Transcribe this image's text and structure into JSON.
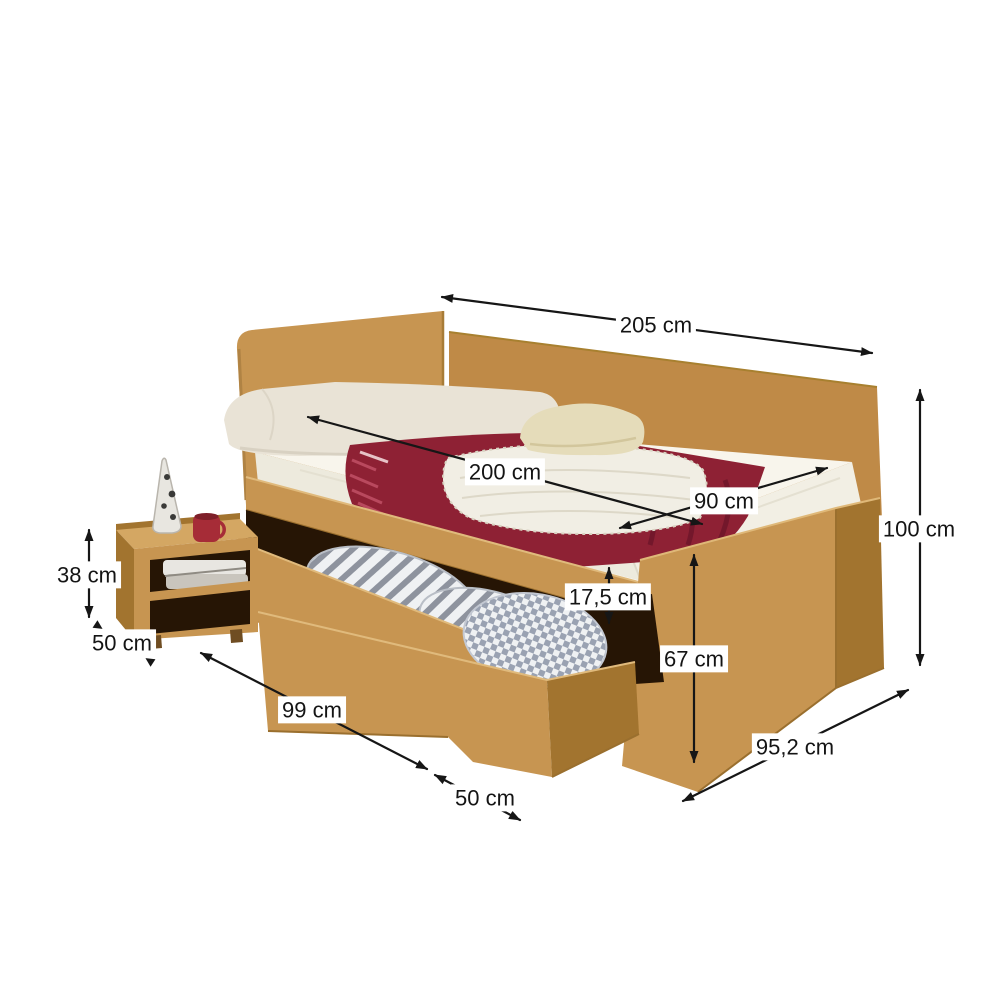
{
  "diagram": {
    "unit": "cm",
    "dims": [
      {
        "name": "total-length",
        "value": "205 cm"
      },
      {
        "name": "mattress-length",
        "value": "200 cm"
      },
      {
        "name": "mattress-width",
        "value": "90 cm"
      },
      {
        "name": "overall-height",
        "value": "100 cm"
      },
      {
        "name": "nightstand-height",
        "value": "38 cm"
      },
      {
        "name": "nightstand-depth",
        "value": "50 cm"
      },
      {
        "name": "drawer-front-length",
        "value": "99 cm"
      },
      {
        "name": "drawer-depth",
        "value": "50 cm"
      },
      {
        "name": "bed-depth",
        "value": "95,2 cm"
      },
      {
        "name": "side-panel-height",
        "value": "67 cm"
      },
      {
        "name": "rail-height",
        "value": "17,5 cm"
      }
    ],
    "colors": {
      "wood-face": "#c79551",
      "wood-face-2": "#bf8a47",
      "wood-top": "#d4a763",
      "wood-side": "#a2742f",
      "wood-deep": "#8a5f25",
      "interior": "#261505",
      "mattress": "#f8f5ec",
      "mattress-side": "#edeadd",
      "pillow": "#e9e3d6",
      "cushion": "#e5dcba",
      "blanket": "#8e2134",
      "blanket-dark": "#6f152a",
      "fringe": "#b9495e",
      "throw": "#f1eee4",
      "bedding": "#eff1f3",
      "bedding-stripe": "#8e939e",
      "mug": "#a62c37",
      "line": "#161616"
    }
  }
}
